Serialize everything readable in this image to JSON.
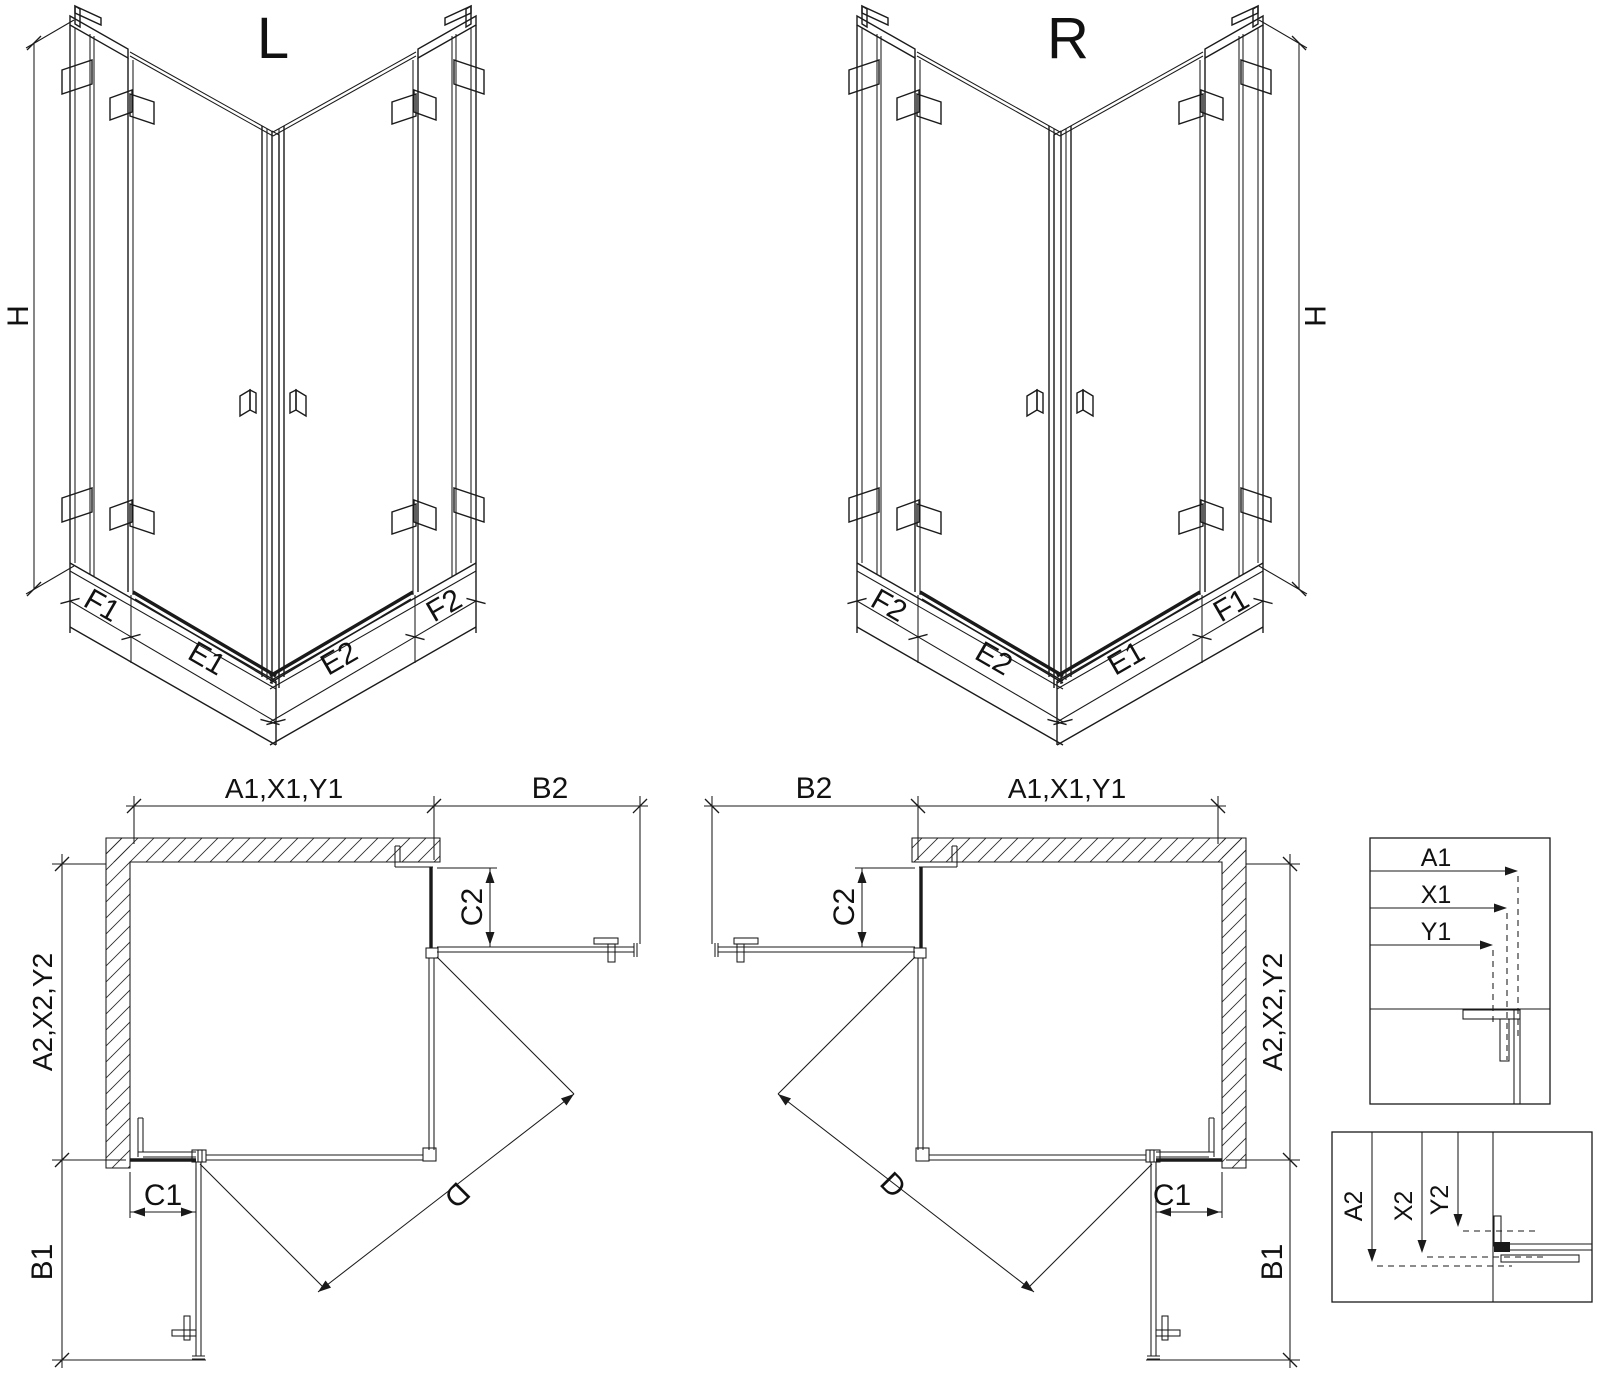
{
  "colors": {
    "line": "#1a1a1a",
    "background": "#ffffff"
  },
  "iso_left": {
    "title": "L",
    "h": "H",
    "f1": "F1",
    "e1": "E1",
    "e2": "E2",
    "f2": "F2"
  },
  "iso_right": {
    "title": "R",
    "h": "H",
    "f1": "F1",
    "e1": "E1",
    "e2": "E2",
    "f2": "F2"
  },
  "plan_left": {
    "a1": "A1,X1,Y1",
    "b2": "B2",
    "c2": "C2",
    "a2": "A2,X2,Y2",
    "c1": "C1",
    "b1": "B1",
    "d": "D"
  },
  "plan_right": {
    "a1": "A1,X1,Y1",
    "b2": "B2",
    "c2": "C2",
    "a2": "A2,X2,Y2",
    "c1": "C1",
    "b1": "B1",
    "d": "D"
  },
  "detail_top": {
    "a1": "A1",
    "x1": "X1",
    "y1": "Y1"
  },
  "detail_bottom": {
    "a2": "A2",
    "x2": "X2",
    "y2": "Y2"
  }
}
